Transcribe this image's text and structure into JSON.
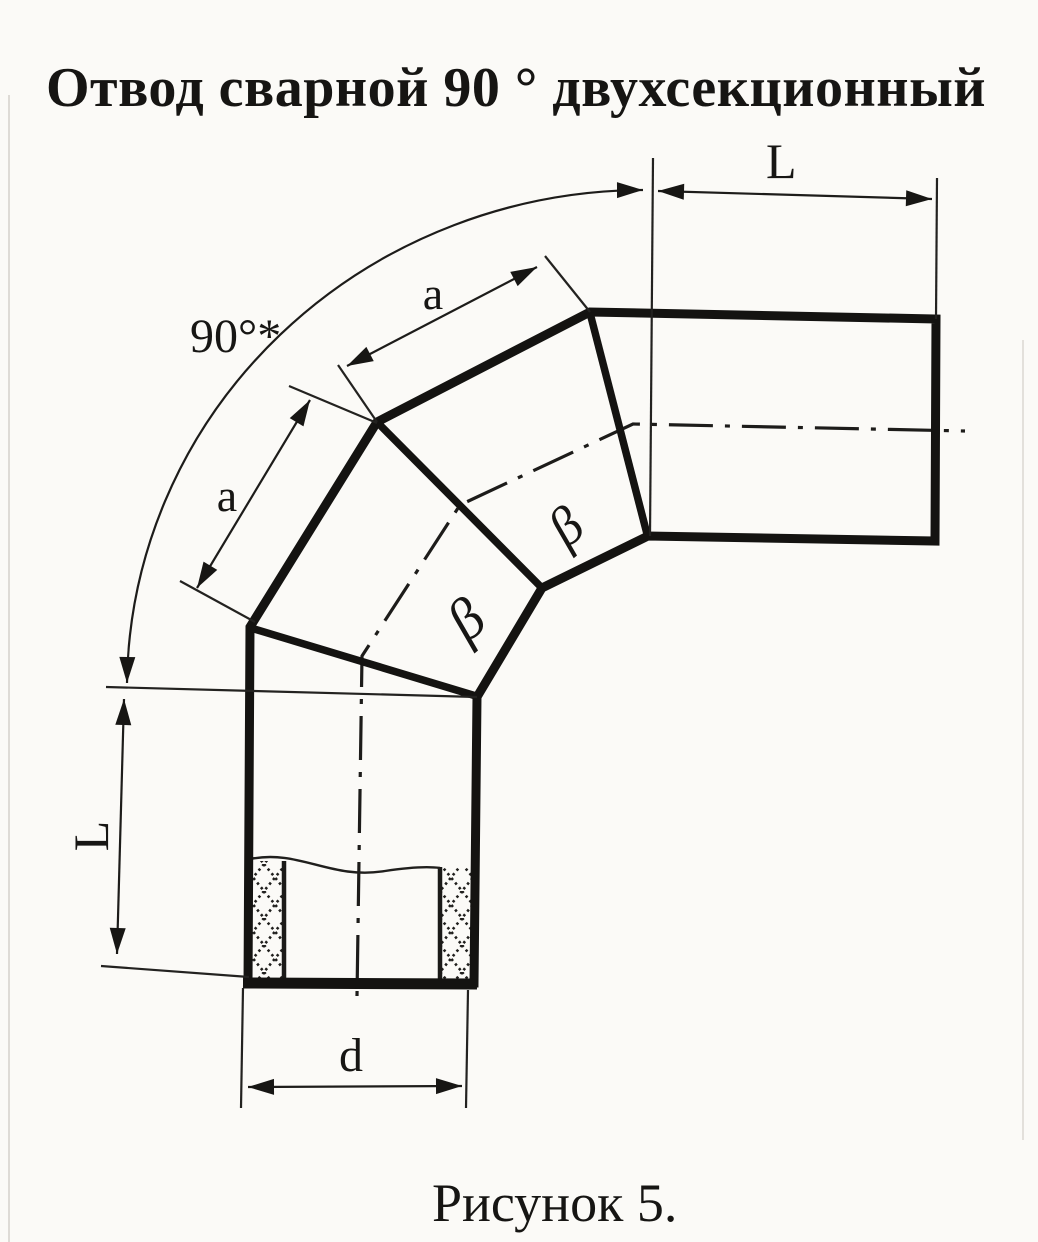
{
  "page": {
    "title": "Отвод сварной 90 ° двухсекционный",
    "caption": "Рисунок 5."
  },
  "labels": {
    "angle": "90°*",
    "length_top": "L",
    "length_left": "L",
    "section_upper": "a",
    "section_lower": "a",
    "diameter": "d",
    "weld_bevel_upper": "β",
    "weld_bevel_lower": "β"
  },
  "colors": {
    "ink": "#1b1a18",
    "paper": "#fbfaf7"
  }
}
